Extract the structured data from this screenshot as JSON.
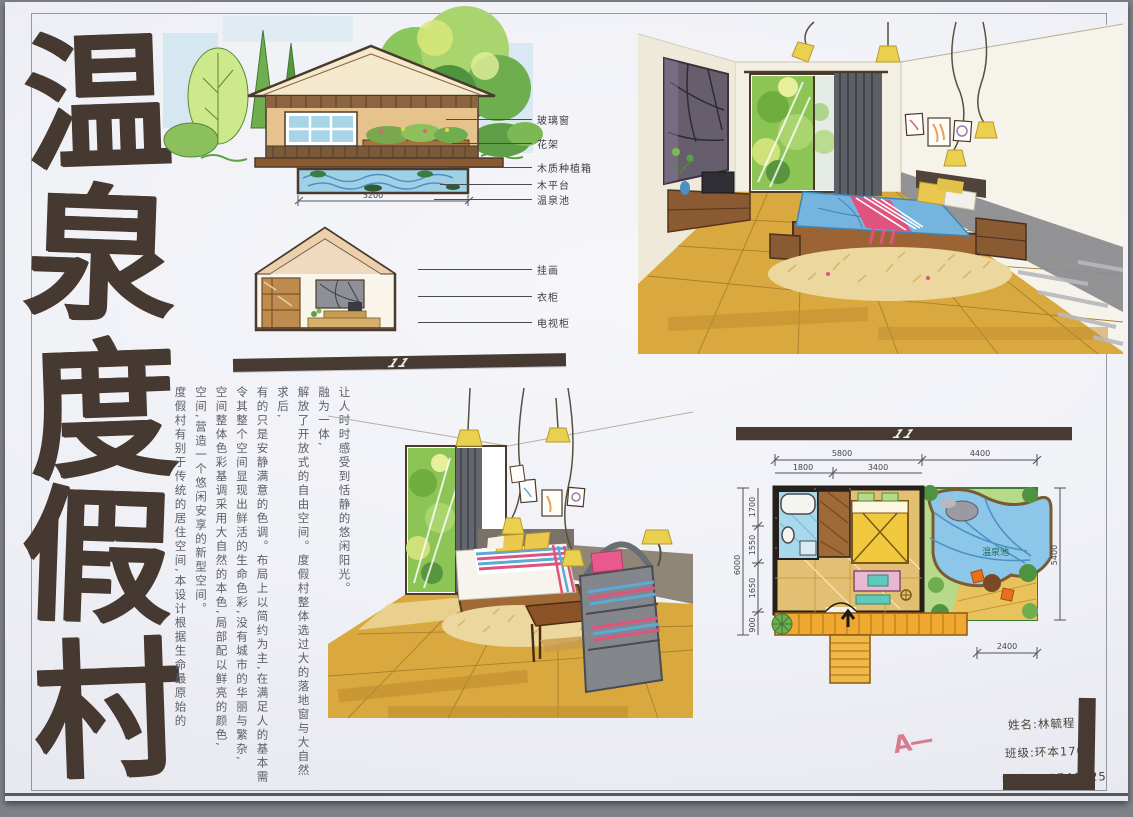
{
  "title": {
    "chars": [
      "温",
      "泉",
      "度",
      "假",
      "村"
    ]
  },
  "elevation": {
    "dimension": "3200",
    "labels": [
      "玻璃窗",
      "花架",
      "木质种植箱",
      "木平台",
      "温泉池"
    ]
  },
  "section": {
    "labels": [
      "挂画",
      "衣柜",
      "电视柜"
    ]
  },
  "dividers": {
    "mark": "11"
  },
  "description": {
    "columns": [
      "度假村有别于传统的居住空间,本设计根据生命最原始的",
      "空间,营造一个悠闲安享的新型空间。",
      "空间整体色彩基调采用大自然的本色,局部配以鲜亮的颜色,",
      "令其整个空间显现出鲜活的生命色彩,没有城市的华丽与繁杂,",
      "有的只是安静满意的色调。布局上以简约为主,在满足人的基本需求后,",
      "解放了开放式的自由空间。度假村整体选过大的落地窗与大自然融为一体,",
      "让人时时感受到恬静的悠闲阳光。"
    ]
  },
  "floor_plan": {
    "pool_label": "温泉池",
    "dims": {
      "top_left": "5800",
      "top_right": "4400",
      "sub_left": "1800",
      "sub_right": "3400",
      "left_total": "6000",
      "left_segments": [
        "1700",
        "1550",
        "1650",
        "900"
      ],
      "right_side": "5400",
      "bottom_right": "2400"
    }
  },
  "info": {
    "name_label": "姓名:",
    "name": "林毓程",
    "class_label": "班级:",
    "class": "环本1708",
    "id_label": "学号:",
    "id": "201740325"
  },
  "grade": "A—",
  "colors": {
    "ink_brown": "#473a33",
    "floor_gold": "#d9a93f",
    "pool_blue": "#8cc6e8",
    "leaf_green": "#7cb854",
    "bed_blue": "#74b4dd",
    "stripe_pink": "#e0537e",
    "pillow_yellow": "#ecc84f",
    "grade_red": "#d4607a"
  }
}
